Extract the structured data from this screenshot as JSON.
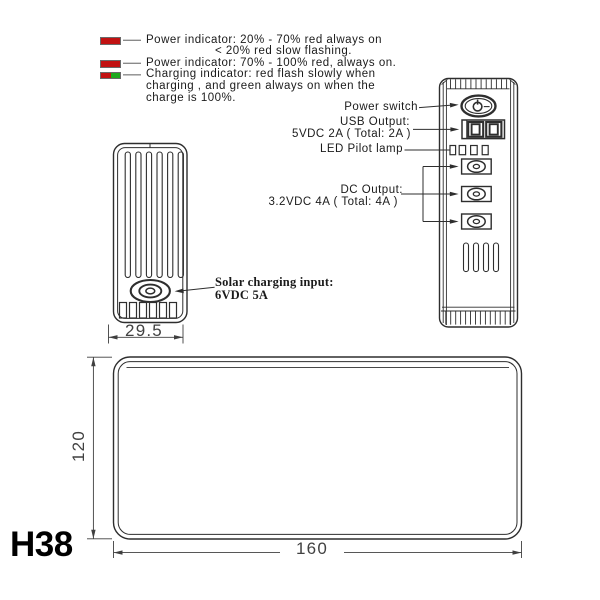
{
  "legend": {
    "swatch_colors": {
      "red": "#c11212",
      "green": "#1ea81e"
    },
    "entries": [
      {
        "icon": "red-indicator-swatch",
        "lines": [
          "Power indicator: 20% - 70% red always on",
          "< 20% red slow flashing."
        ]
      },
      {
        "icon": "red-indicator-swatch",
        "lines": [
          "Power indicator: 70% - 100% red, always on."
        ]
      },
      {
        "icon": "red-green-indicator-swatch",
        "lines": [
          "Charging indicator: red flash slowly when",
          "charging , and green always on when the",
          "charge is 100%."
        ]
      }
    ]
  },
  "callouts": {
    "power_switch": "Power switch",
    "usb_output": {
      "line1": "USB Output:",
      "line2": "5VDC 2A ( Total: 2A )"
    },
    "led_pilot_lamp": "LED Pilot lamp",
    "dc_output": {
      "line1": "DC Output:",
      "line2": "3.2VDC 4A ( Total: 4A )"
    },
    "solar_input": {
      "line1": "Solar charging input:",
      "line2": "6VDC 5A"
    }
  },
  "dimensions": {
    "front_view_width_mm": "29.5",
    "top_view_length_mm": "160",
    "top_view_width_mm": "120"
  },
  "model_code": "H38",
  "drawing": {
    "line_color": "#2e2e2e"
  }
}
